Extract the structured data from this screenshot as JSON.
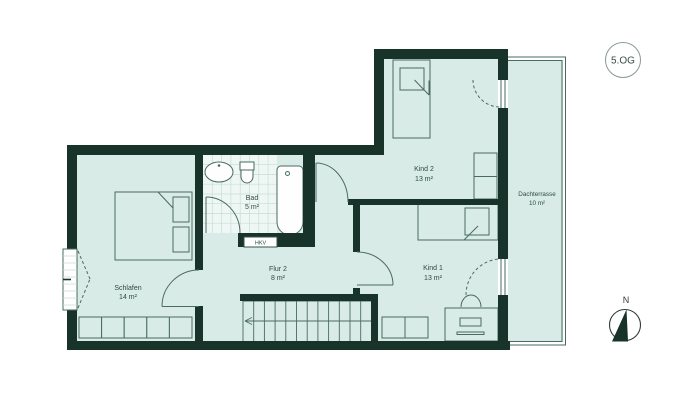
{
  "floor_badge": {
    "label": "5.OG"
  },
  "compass": {
    "north": "N"
  },
  "hkv_label": "HKV",
  "rooms": [
    {
      "id": "schlafen",
      "name": "Schlafen",
      "area": "14 m²"
    },
    {
      "id": "bad",
      "name": "Bad",
      "area": "5 m²"
    },
    {
      "id": "flur2",
      "name": "Flur 2",
      "area": "8 m²"
    },
    {
      "id": "kind2",
      "name": "Kind 2",
      "area": "13 m²"
    },
    {
      "id": "kind1",
      "name": "Kind 1",
      "area": "13 m²"
    },
    {
      "id": "dachterrasse",
      "name": "Dachterrasse",
      "area": "10 m²"
    }
  ],
  "colors": {
    "wall": "#17332a",
    "room_fill": "#d8ebe7",
    "line": "#4a6a61",
    "text": "#2e4b40",
    "fixture_fill": "#fdfefd",
    "tile_fill": "#eff7f4",
    "tile_line": "#c6ddd6"
  }
}
